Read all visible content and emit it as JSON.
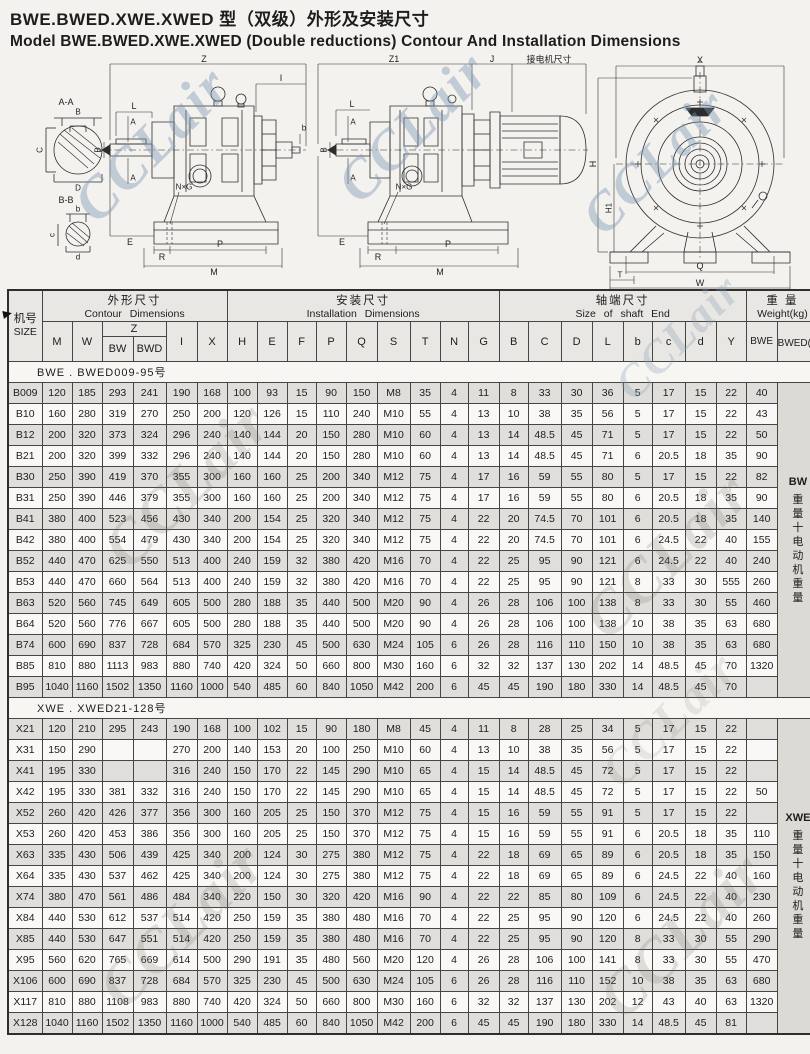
{
  "page": {
    "title_zh": "BWE.BWED.XWE.XWED 型（双级）外形及安装尺寸",
    "title_en": "Model BWE.BWED.XWE.XWED (Double reductions) Contour And Installation Dimensions"
  },
  "watermark": {
    "text": "CCLair"
  },
  "drawings": {
    "left": {
      "labels": {
        "z": "Z",
        "l": "L",
        "a_top": "A",
        "a_bot": "A",
        "dia": "B",
        "i": "I",
        "b_right": "b",
        "nxg": "N×G",
        "e": "E",
        "r": "R",
        "p": "P",
        "m": "M",
        "aa": "A-A",
        "aa_b": "B",
        "aa_c": "C",
        "aa_d": "D",
        "bb": "B-B",
        "bb_b": "b",
        "bb_c": "c",
        "bb_d": "d"
      }
    },
    "middle": {
      "labels": {
        "z1": "Z1",
        "j": "J",
        "motor": "接电机尺寸",
        "l": "L",
        "a_top": "A",
        "a_bot": "A",
        "dia": "B",
        "nxg": "N×G",
        "e": "E",
        "r": "R",
        "p": "P",
        "m": "M"
      }
    },
    "right": {
      "labels": {
        "x": "X",
        "h": "H",
        "h1": "H1",
        "q": "Q",
        "t": "T",
        "w": "W"
      }
    }
  },
  "table": {
    "size_header": {
      "zh": "机号",
      "en": "SIZE"
    },
    "groups": [
      {
        "zh": "外形尺寸",
        "en": "Contour Dimensions",
        "span": 6
      },
      {
        "zh": "安装尺寸",
        "en": "Installation Dimensions",
        "span": 9
      },
      {
        "zh": "轴端尺寸",
        "en": "Size of shaft End",
        "span": 8
      },
      {
        "zh": "重 量",
        "en": "Weight(kg)",
        "span": 2
      }
    ],
    "cols_before_z": [
      "M",
      "W"
    ],
    "z": {
      "label": "Z",
      "subs": [
        "BW",
        "BWD"
      ]
    },
    "cols_after_z": [
      "I",
      "X",
      "H",
      "E",
      "F",
      "P",
      "Q",
      "S",
      "T",
      "N",
      "G",
      "B",
      "C",
      "D",
      "L",
      "b",
      "c",
      "d",
      "Y"
    ],
    "weight_cols": [
      "BWE",
      "BWED(约)"
    ],
    "sections": [
      {
        "label": "BWE . BWED009-95号",
        "side_note": {
          "model": "BW",
          "suffix": "重量十电动机重量"
        },
        "rows": [
          {
            "size": "B009",
            "values": [
              "120",
              "185",
              "293",
              "241",
              "190",
              "168",
              "100",
              "93",
              "15",
              "90",
              "150",
              "M8",
              "35",
              "4",
              "11",
              "8",
              "33",
              "30",
              "36",
              "5",
              "17",
              "15",
              "22",
              "40"
            ]
          },
          {
            "size": "B10",
            "values": [
              "160",
              "280",
              "319",
              "270",
              "250",
              "200",
              "120",
              "126",
              "15",
              "110",
              "240",
              "M10",
              "55",
              "4",
              "13",
              "10",
              "38",
              "35",
              "56",
              "5",
              "17",
              "15",
              "22",
              "43"
            ]
          },
          {
            "size": "B12",
            "values": [
              "200",
              "320",
              "373",
              "324",
              "296",
              "240",
              "140",
              "144",
              "20",
              "150",
              "280",
              "M10",
              "60",
              "4",
              "13",
              "14",
              "48.5",
              "45",
              "71",
              "5",
              "17",
              "15",
              "22",
              "50"
            ]
          },
          {
            "size": "B21",
            "values": [
              "200",
              "320",
              "399",
              "332",
              "296",
              "240",
              "140",
              "144",
              "20",
              "150",
              "280",
              "M10",
              "60",
              "4",
              "13",
              "14",
              "48.5",
              "45",
              "71",
              "6",
              "20.5",
              "18",
              "35",
              "90"
            ]
          },
          {
            "size": "B30",
            "values": [
              "250",
              "390",
              "419",
              "370",
              "355",
              "300",
              "160",
              "160",
              "25",
              "200",
              "340",
              "M12",
              "75",
              "4",
              "17",
              "16",
              "59",
              "55",
              "80",
              "5",
              "17",
              "15",
              "22",
              "82"
            ]
          },
          {
            "size": "B31",
            "values": [
              "250",
              "390",
              "446",
              "379",
              "355",
              "300",
              "160",
              "160",
              "25",
              "200",
              "340",
              "M12",
              "75",
              "4",
              "17",
              "16",
              "59",
              "55",
              "80",
              "6",
              "20.5",
              "18",
              "35",
              "90"
            ]
          },
          {
            "size": "B41",
            "values": [
              "380",
              "400",
              "523",
              "456",
              "430",
              "340",
              "200",
              "154",
              "25",
              "320",
              "340",
              "M12",
              "75",
              "4",
              "22",
              "20",
              "74.5",
              "70",
              "101",
              "6",
              "20.5",
              "18",
              "35",
              "140"
            ]
          },
          {
            "size": "B42",
            "values": [
              "380",
              "400",
              "554",
              "479",
              "430",
              "340",
              "200",
              "154",
              "25",
              "320",
              "340",
              "M12",
              "75",
              "4",
              "22",
              "20",
              "74.5",
              "70",
              "101",
              "6",
              "24.5",
              "22",
              "40",
              "155"
            ]
          },
          {
            "size": "B52",
            "values": [
              "440",
              "470",
              "625",
              "550",
              "513",
              "400",
              "240",
              "159",
              "32",
              "380",
              "420",
              "M16",
              "70",
              "4",
              "22",
              "25",
              "95",
              "90",
              "121",
              "6",
              "24.5",
              "22",
              "40",
              "240"
            ]
          },
          {
            "size": "B53",
            "values": [
              "440",
              "470",
              "660",
              "564",
              "513",
              "400",
              "240",
              "159",
              "32",
              "380",
              "420",
              "M16",
              "70",
              "4",
              "22",
              "25",
              "95",
              "90",
              "121",
              "8",
              "33",
              "30",
              "555",
              "260"
            ]
          },
          {
            "size": "B63",
            "values": [
              "520",
              "560",
              "745",
              "649",
              "605",
              "500",
              "280",
              "188",
              "35",
              "440",
              "500",
              "M20",
              "90",
              "4",
              "26",
              "28",
              "106",
              "100",
              "138",
              "8",
              "33",
              "30",
              "55",
              "460"
            ]
          },
          {
            "size": "B64",
            "values": [
              "520",
              "560",
              "776",
              "667",
              "605",
              "500",
              "280",
              "188",
              "35",
              "440",
              "500",
              "M20",
              "90",
              "4",
              "26",
              "28",
              "106",
              "100",
              "138",
              "10",
              "38",
              "35",
              "63",
              "680"
            ]
          },
          {
            "size": "B74",
            "values": [
              "600",
              "690",
              "837",
              "728",
              "684",
              "570",
              "325",
              "230",
              "45",
              "500",
              "630",
              "M24",
              "105",
              "6",
              "26",
              "28",
              "116",
              "110",
              "150",
              "10",
              "38",
              "35",
              "63",
              "680"
            ]
          },
          {
            "size": "B85",
            "values": [
              "810",
              "880",
              "1113",
              "983",
              "880",
              "740",
              "420",
              "324",
              "50",
              "660",
              "800",
              "M30",
              "160",
              "6",
              "32",
              "32",
              "137",
              "130",
              "202",
              "14",
              "48.5",
              "45",
              "70",
              "1320"
            ]
          },
          {
            "size": "B95",
            "values": [
              "1040",
              "1160",
              "1502",
              "1350",
              "1160",
              "1000",
              "540",
              "485",
              "60",
              "840",
              "1050",
              "M42",
              "200",
              "6",
              "45",
              "45",
              "190",
              "180",
              "330",
              "14",
              "48.5",
              "45",
              "70",
              ""
            ]
          }
        ]
      },
      {
        "label": "XWE . XWED21-128号",
        "side_note": {
          "model": "XWE",
          "suffix": "重量十电动机重量"
        },
        "rows": [
          {
            "size": "X21",
            "values": [
              "120",
              "210",
              "295",
              "243",
              "190",
              "168",
              "100",
              "102",
              "15",
              "90",
              "180",
              "M8",
              "45",
              "4",
              "11",
              "8",
              "28",
              "25",
              "34",
              "5",
              "17",
              "15",
              "22",
              ""
            ]
          },
          {
            "size": "X31",
            "values": [
              "150",
              "290",
              "",
              "",
              "270",
              "200",
              "140",
              "153",
              "20",
              "100",
              "250",
              "M10",
              "60",
              "4",
              "13",
              "10",
              "38",
              "35",
              "56",
              "5",
              "17",
              "15",
              "22",
              ""
            ]
          },
          {
            "size": "X41",
            "values": [
              "195",
              "330",
              "",
              "",
              "316",
              "240",
              "150",
              "170",
              "22",
              "145",
              "290",
              "M10",
              "65",
              "4",
              "15",
              "14",
              "48.5",
              "45",
              "72",
              "5",
              "17",
              "15",
              "22",
              ""
            ]
          },
          {
            "size": "X42",
            "values": [
              "195",
              "330",
              "381",
              "332",
              "316",
              "240",
              "150",
              "170",
              "22",
              "145",
              "290",
              "M10",
              "65",
              "4",
              "15",
              "14",
              "48.5",
              "45",
              "72",
              "5",
              "17",
              "15",
              "22",
              "50"
            ]
          },
          {
            "size": "X52",
            "values": [
              "260",
              "420",
              "426",
              "377",
              "356",
              "300",
              "160",
              "205",
              "25",
              "150",
              "370",
              "M12",
              "75",
              "4",
              "15",
              "16",
              "59",
              "55",
              "91",
              "5",
              "17",
              "15",
              "22",
              ""
            ]
          },
          {
            "size": "X53",
            "values": [
              "260",
              "420",
              "453",
              "386",
              "356",
              "300",
              "160",
              "205",
              "25",
              "150",
              "370",
              "M12",
              "75",
              "4",
              "15",
              "16",
              "59",
              "55",
              "91",
              "6",
              "20.5",
              "18",
              "35",
              "110"
            ]
          },
          {
            "size": "X63",
            "values": [
              "335",
              "430",
              "506",
              "439",
              "425",
              "340",
              "200",
              "124",
              "30",
              "275",
              "380",
              "M12",
              "75",
              "4",
              "22",
              "18",
              "69",
              "65",
              "89",
              "6",
              "20.5",
              "18",
              "35",
              "150"
            ]
          },
          {
            "size": "X64",
            "values": [
              "335",
              "430",
              "537",
              "462",
              "425",
              "340",
              "200",
              "124",
              "30",
              "275",
              "380",
              "M12",
              "75",
              "4",
              "22",
              "18",
              "69",
              "65",
              "89",
              "6",
              "24.5",
              "22",
              "40",
              "160"
            ]
          },
          {
            "size": "X74",
            "values": [
              "380",
              "470",
              "561",
              "486",
              "484",
              "340",
              "220",
              "150",
              "30",
              "320",
              "420",
              "M16",
              "90",
              "4",
              "22",
              "22",
              "85",
              "80",
              "109",
              "6",
              "24.5",
              "22",
              "40",
              "230"
            ]
          },
          {
            "size": "X84",
            "values": [
              "440",
              "530",
              "612",
              "537",
              "514",
              "420",
              "250",
              "159",
              "35",
              "380",
              "480",
              "M16",
              "70",
              "4",
              "22",
              "25",
              "95",
              "90",
              "120",
              "6",
              "24.5",
              "22",
              "40",
              "260"
            ]
          },
          {
            "size": "X85",
            "values": [
              "440",
              "530",
              "647",
              "551",
              "514",
              "420",
              "250",
              "159",
              "35",
              "380",
              "480",
              "M16",
              "70",
              "4",
              "22",
              "25",
              "95",
              "90",
              "120",
              "8",
              "33",
              "30",
              "55",
              "290"
            ]
          },
          {
            "size": "X95",
            "values": [
              "560",
              "620",
              "765",
              "669",
              "614",
              "500",
              "290",
              "191",
              "35",
              "480",
              "560",
              "M20",
              "120",
              "4",
              "26",
              "28",
              "106",
              "100",
              "141",
              "8",
              "33",
              "30",
              "55",
              "470"
            ]
          },
          {
            "size": "X106",
            "values": [
              "600",
              "690",
              "837",
              "728",
              "684",
              "570",
              "325",
              "230",
              "45",
              "500",
              "630",
              "M24",
              "105",
              "6",
              "26",
              "28",
              "116",
              "110",
              "152",
              "10",
              "38",
              "35",
              "63",
              "680"
            ]
          },
          {
            "size": "X117",
            "values": [
              "810",
              "880",
              "1108",
              "983",
              "880",
              "740",
              "420",
              "324",
              "50",
              "660",
              "800",
              "M30",
              "160",
              "6",
              "32",
              "32",
              "137",
              "130",
              "202",
              "12",
              "43",
              "40",
              "63",
              "1320"
            ]
          },
          {
            "size": "X128",
            "values": [
              "1040",
              "1160",
              "1502",
              "1350",
              "1160",
              "1000",
              "540",
              "485",
              "60",
              "840",
              "1050",
              "M42",
              "200",
              "6",
              "45",
              "45",
              "190",
              "180",
              "330",
              "14",
              "48.5",
              "45",
              "81",
              ""
            ]
          }
        ]
      }
    ]
  }
}
